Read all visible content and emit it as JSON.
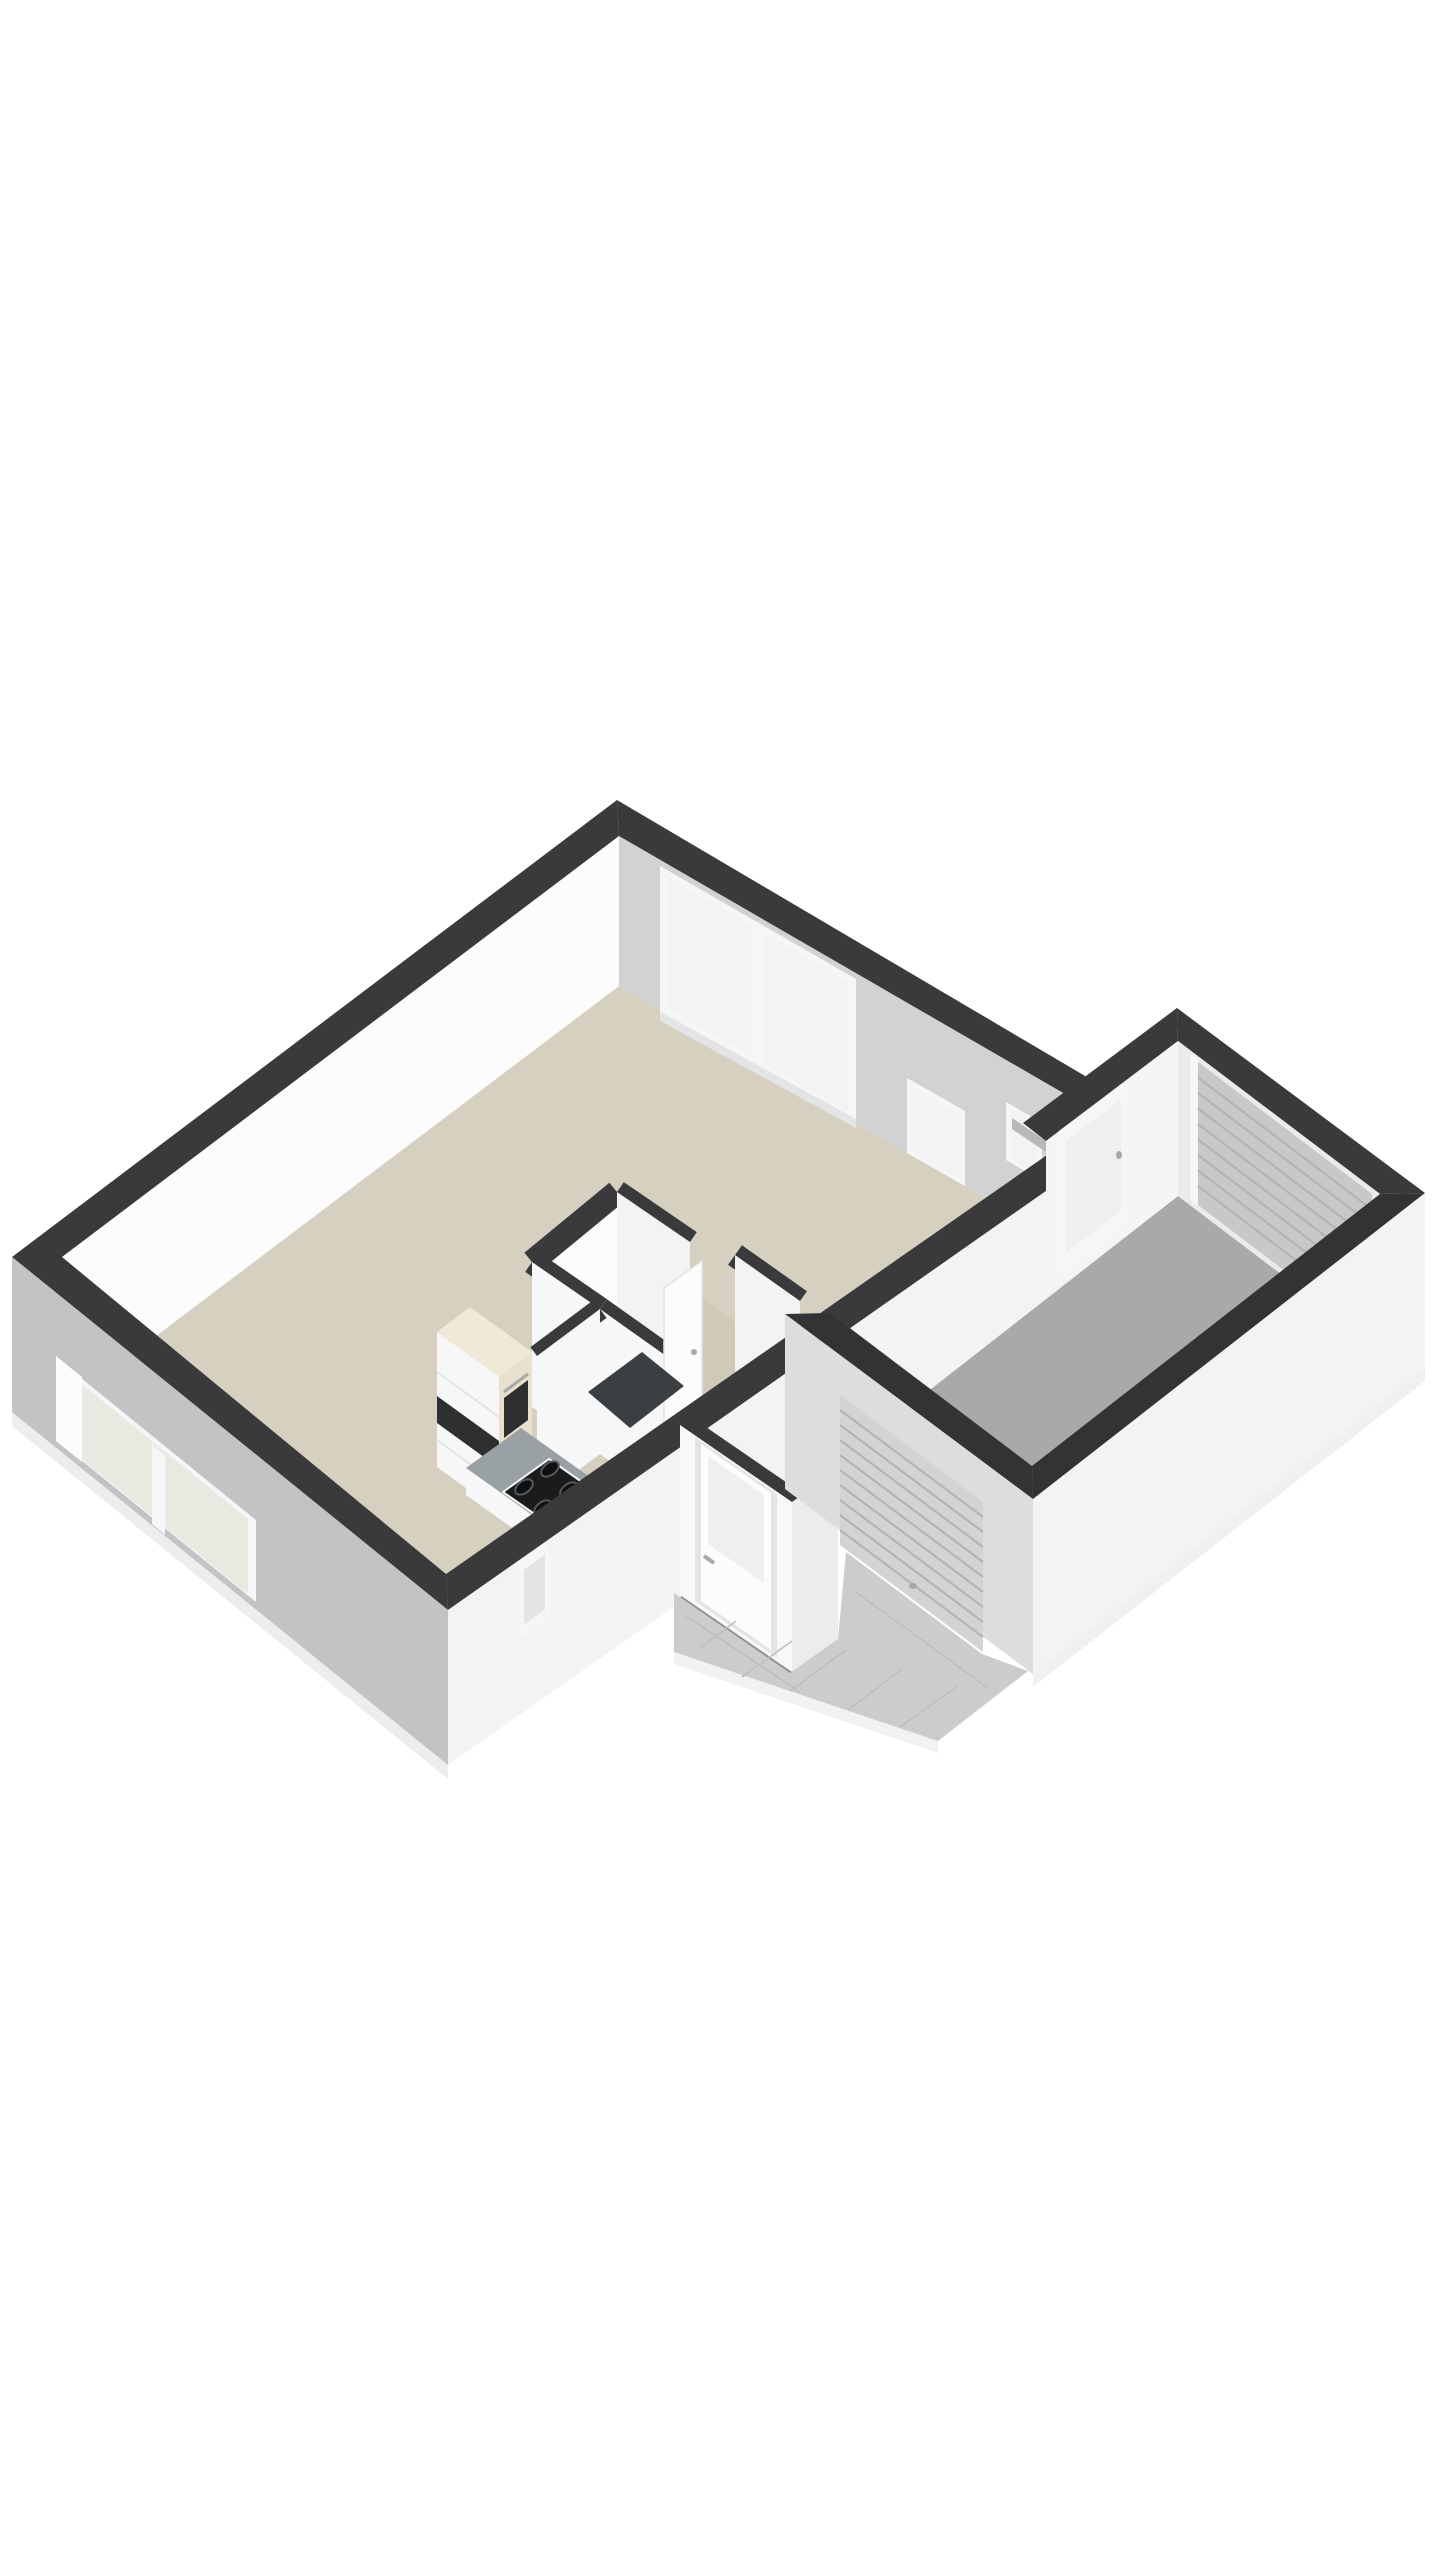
{
  "background": "#ffffff",
  "colors": {
    "background": "#ffffff",
    "wallTop": "#3a3a3c",
    "wallTopDark": "#333335",
    "extWhite": "#f3f3f4",
    "extWhiteBright": "#f8f8f9",
    "extGray": "#c2c3c5",
    "intWhite": "#fcfcfd",
    "intGray": "#d1d2d4",
    "intFaceB": "#f2f3f4",
    "intFaceC": "#f6f7f8",
    "floorMain": "#d6d0c0",
    "floorHall": "#cfc9b8",
    "floorGarage": "#a8a9ab",
    "floorWc": "#3c3f42",
    "tile": "#cbccce",
    "tileLine": "#bcbec0",
    "frame": "#f5f6f7",
    "frameShade": "#e3e4e5",
    "glass": "#f1f3f4",
    "glassWarm": "#e9e8e1",
    "glassCool": "#edeff0",
    "roller": "#c6c8c9",
    "rollerExt": "#d2d3d5",
    "rollerLine": "#b2b4b5",
    "cabCream": "#e9e1cd",
    "cabCreamTop": "#f0e9d8",
    "cabWhite": "#f7f7f8",
    "counter": "#9aa1a4",
    "dark": "#2d2f31",
    "cooktop": "#191b1d",
    "burner": "#0e0f10",
    "burnerRing": "#56595b",
    "metal": "#a7a8aa",
    "metalDark": "#8e8f91",
    "metalLight": "#b7b8ba",
    "porchReturn": "#ececed",
    "garIntA": "#f4f5f6",
    "garIntB": "#eaebec",
    "garExtSW": "#dcdddf",
    "shadowTint": "#000000"
  },
  "elements": [
    "living-room-floor",
    "hall-floor",
    "wc-floor",
    "garage-floor",
    "kitchen-cabinets",
    "kitchen-counter",
    "cooktop-icon",
    "oven-icon",
    "front-door",
    "hall-door",
    "garage-side-door",
    "garage-roller-door-front",
    "garage-roller-door-rear",
    "living-room-window-large",
    "living-room-window-medium",
    "living-room-window-small",
    "side-wall-window",
    "slit-window",
    "driveway-tiles"
  ]
}
